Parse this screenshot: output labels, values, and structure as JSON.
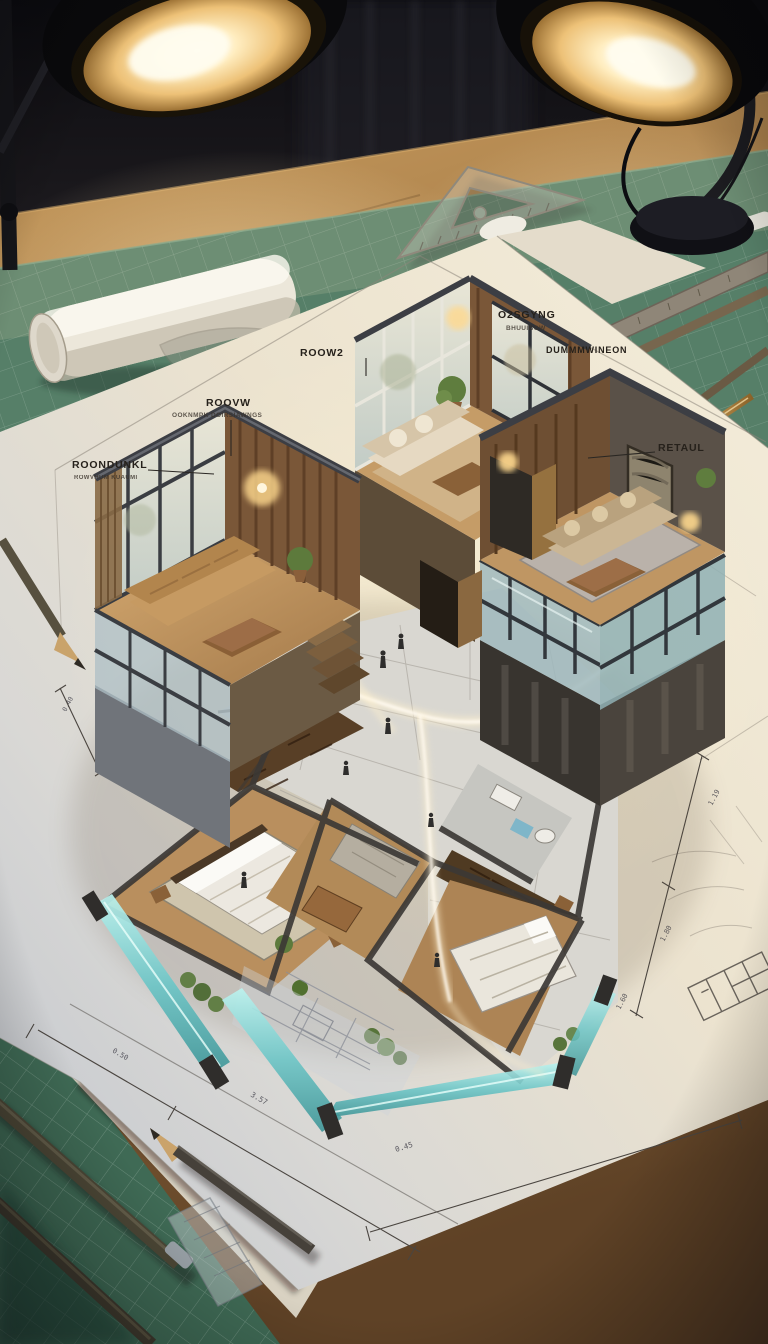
{
  "scene": {
    "type": "photorealistic architectural visualization on a drafting desk",
    "objects": [
      "desk-lamp-left",
      "desk-lamp-right",
      "wooden-desk",
      "green-cutting-mat",
      "rolled-paper-tube",
      "french-curve",
      "set-square-triangle",
      "rulers",
      "wooden-pencils",
      "gold-pen",
      "blueprint-paper-sheets",
      "isometric-cutaway-house-model",
      "lower-floor-plan-with-furniture",
      "tiny-walking-figures",
      "glowing-circulation-trails",
      "teal-glass-balconies"
    ]
  },
  "annotations": {
    "far_left": {
      "label": "ROONDUNKL",
      "sublabel": "ROWVHUM KUAUMI"
    },
    "center_left": {
      "label": "ROOVW",
      "sublabel": "OOKNMPK DOIRSIAWNGS"
    },
    "room2": {
      "label": "ROOW2"
    },
    "top_right": {
      "label": "O2SGYNG",
      "sublabel": "BHUUIBOW"
    },
    "right_band": {
      "label": "DUMMMWINEON"
    },
    "retail": {
      "label": "RETAUL"
    }
  },
  "dimensions": {
    "bottom_left": "0.50",
    "bottom_mid": "3.57",
    "bottom_right": "0.45",
    "right_top": "1.19",
    "right_mid": "1.80",
    "right_low": "1.60",
    "left": "0.40"
  },
  "colors": {
    "background_dark": "#121216",
    "desk_wood": "#9a7040",
    "cutting_mat_green": "#567f68",
    "paper_warm": "#f0e8d6",
    "paper_cool": "#c2c7cf",
    "lamp_glow": "#ffedc0",
    "model_wood": "#a87f4e",
    "wall_slate": "#4a4d52",
    "glass_teal": "#6cc5c6",
    "trail_glow": "#fff3d6",
    "ink": "#26211b"
  }
}
